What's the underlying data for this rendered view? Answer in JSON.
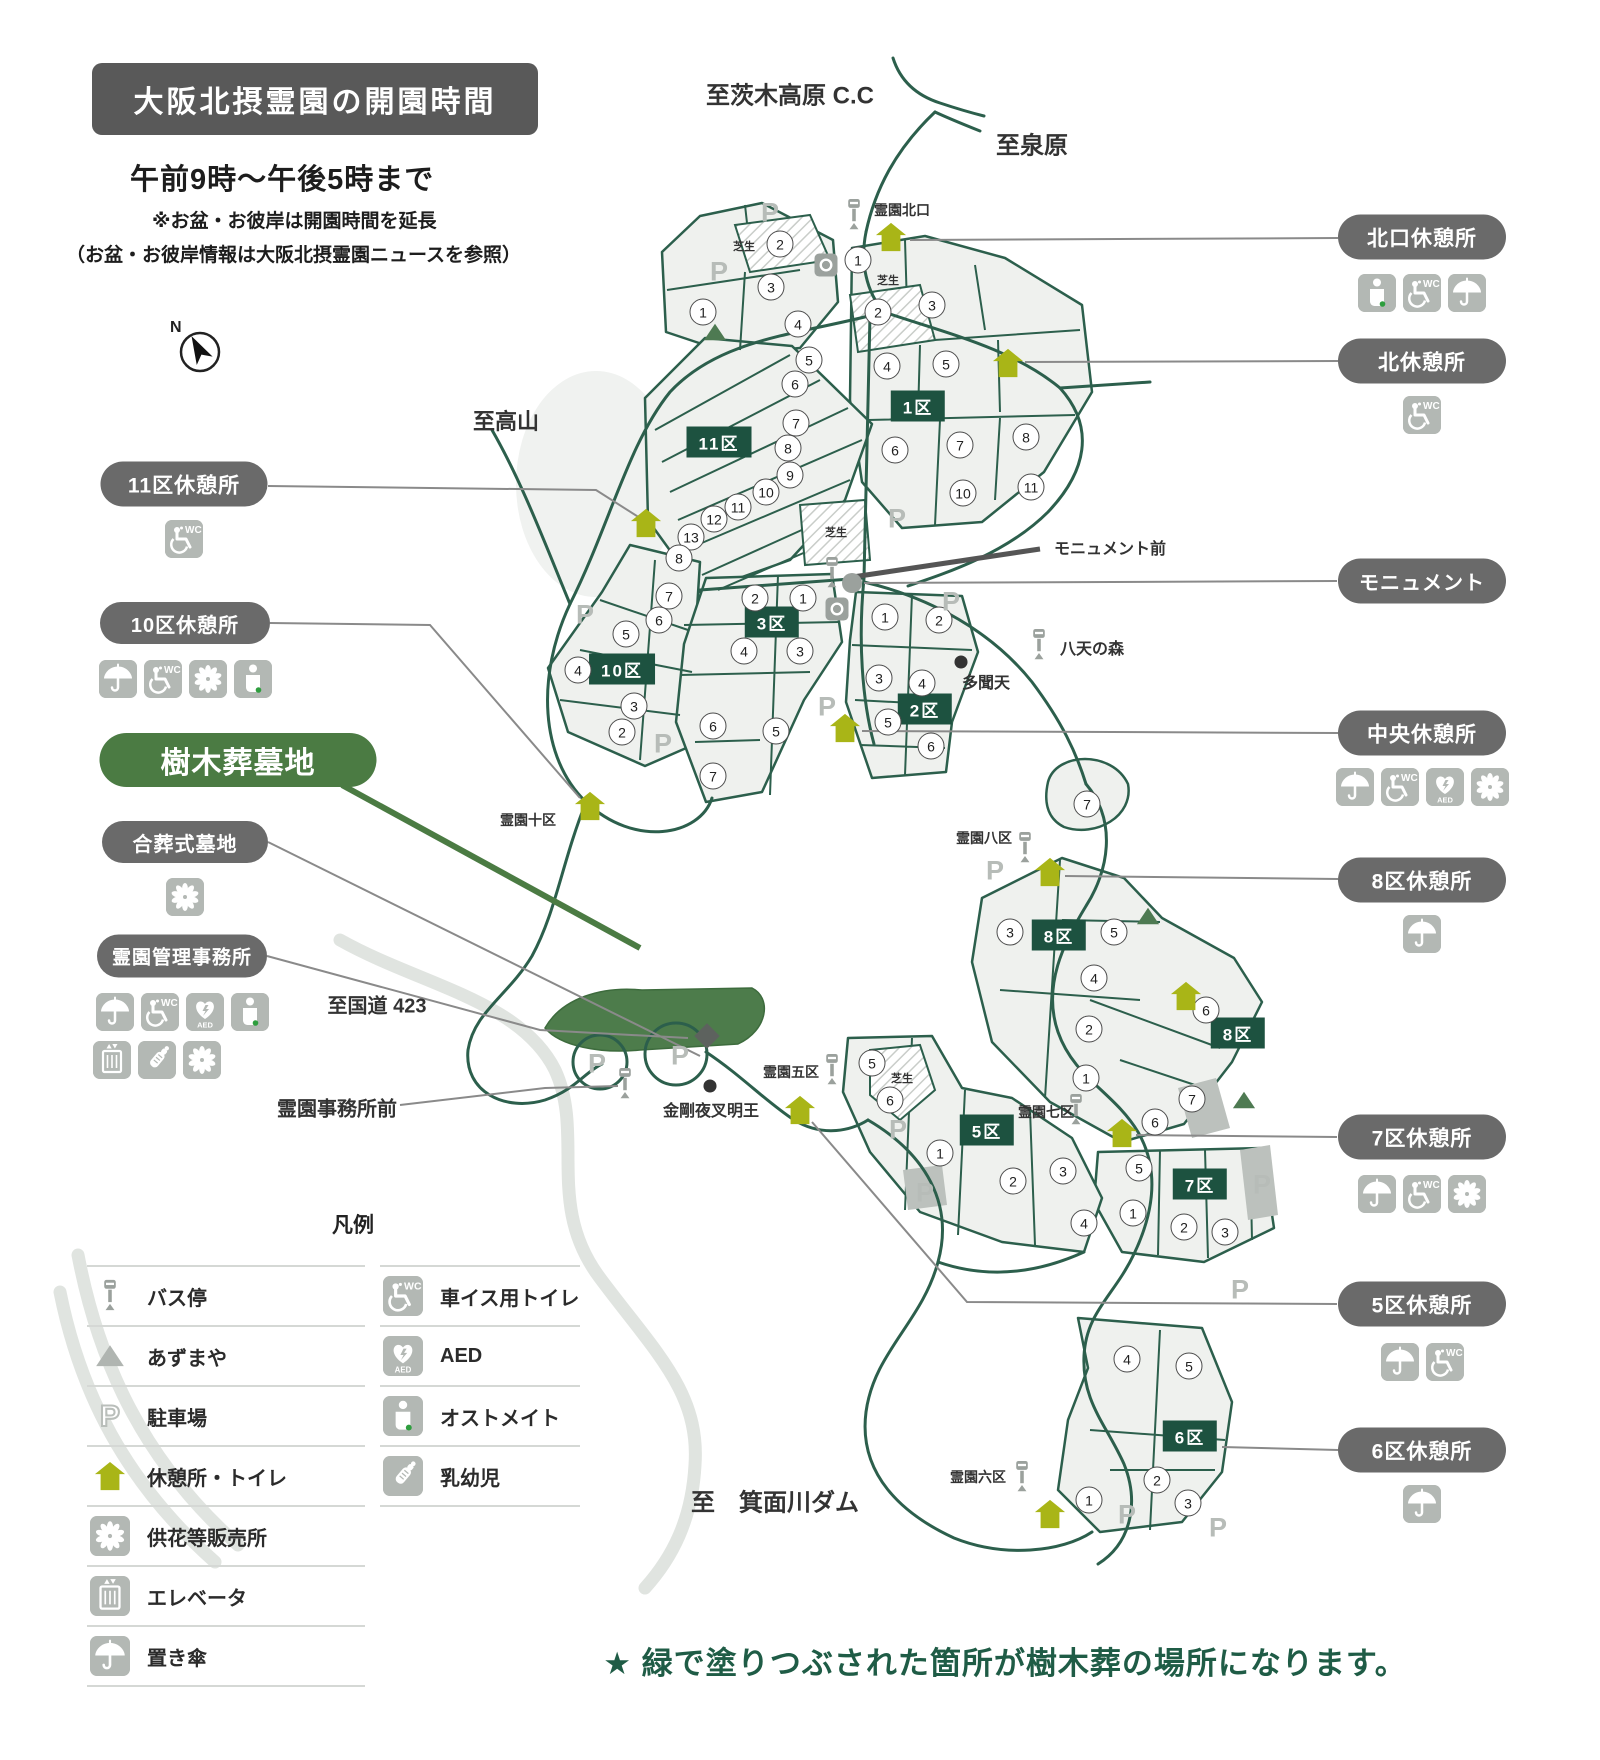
{
  "header": {
    "title": "大阪北摂霊園の開園時間",
    "hours": "午前9時〜午後5時まで",
    "note1": "※お盆・お彼岸は開園時間を延長",
    "note2": "（お盆・お彼岸情報は大阪北摂霊園ニュースを参照）"
  },
  "compass": {
    "label": "N"
  },
  "footer": {
    "note": "★ 緑で塗りつぶされた箇所が樹木葬の場所になります。"
  },
  "colors": {
    "road_green": "#2c5f4c",
    "plot_fill": "#eff1ee",
    "badge_green": "#1d5240",
    "resthouse_olive": "#a9b517",
    "pill_gray": "#6a6a6a",
    "pill_green": "#4b7b43",
    "tree_burial_green": "#4d7c4b",
    "footer_green": "#1f5c46",
    "icon_gray": "#b3b8b4"
  },
  "legend": {
    "title": "凡例",
    "left": [
      {
        "icon": "bus",
        "label": "バス停"
      },
      {
        "icon": "pavilion-gray",
        "label": "あずまや"
      },
      {
        "icon": "parking-outline",
        "label": "駐車場"
      },
      {
        "icon": "resthouse",
        "label": "休憩所・トイレ"
      },
      {
        "icon": "flower",
        "label": "供花等販売所"
      },
      {
        "icon": "elevator",
        "label": "エレベータ"
      },
      {
        "icon": "umbrella",
        "label": "置き傘"
      }
    ],
    "right": [
      {
        "icon": "wheelchair-wc",
        "label": "車イス用トイレ"
      },
      {
        "icon": "aed",
        "label": "AED"
      },
      {
        "icon": "ostomate",
        "label": "オストメイト"
      },
      {
        "icon": "baby",
        "label": "乳幼児"
      }
    ]
  },
  "callouts": [
    {
      "id": "kitaguchi-rest",
      "label": "北口休憩所",
      "x": 1422,
      "y": 237,
      "w": 168,
      "h": 45,
      "fs": 21,
      "style": "gray",
      "icons": [
        "ostomate",
        "wheelchair-wc",
        "umbrella"
      ],
      "icons_y": 274
    },
    {
      "id": "kita-rest",
      "label": "北休憩所",
      "x": 1422,
      "y": 361,
      "w": 168,
      "h": 45,
      "fs": 21,
      "style": "gray",
      "icons": [
        "wheelchair-wc"
      ],
      "icons_y": 396
    },
    {
      "id": "monument",
      "label": "モニュメント",
      "x": 1422,
      "y": 581,
      "w": 168,
      "h": 45,
      "fs": 20,
      "style": "gray",
      "icons": [],
      "icons_y": 0
    },
    {
      "id": "chuo-rest",
      "label": "中央休憩所",
      "x": 1422,
      "y": 733,
      "w": 168,
      "h": 45,
      "fs": 21,
      "style": "gray",
      "icons": [
        "umbrella",
        "wheelchair-wc",
        "aed",
        "flower"
      ],
      "icons_y": 768
    },
    {
      "id": "8ku-rest",
      "label": "8区休憩所",
      "x": 1422,
      "y": 880,
      "w": 168,
      "h": 45,
      "fs": 21,
      "style": "gray",
      "icons": [
        "umbrella"
      ],
      "icons_y": 915
    },
    {
      "id": "7ku-rest",
      "label": "7区休憩所",
      "x": 1422,
      "y": 1137,
      "w": 168,
      "h": 45,
      "fs": 21,
      "style": "gray",
      "icons": [
        "umbrella",
        "wheelchair-wc",
        "flower"
      ],
      "icons_y": 1175
    },
    {
      "id": "5ku-rest",
      "label": "5区休憩所",
      "x": 1422,
      "y": 1304,
      "w": 168,
      "h": 45,
      "fs": 21,
      "style": "gray",
      "icons": [
        "umbrella",
        "wheelchair-wc"
      ],
      "icons_y": 1343
    },
    {
      "id": "6ku-rest",
      "label": "6区休憩所",
      "x": 1422,
      "y": 1450,
      "w": 168,
      "h": 45,
      "fs": 21,
      "style": "gray",
      "icons": [
        "umbrella"
      ],
      "icons_y": 1485
    },
    {
      "id": "11ku-rest",
      "label": "11区休憩所",
      "x": 184,
      "y": 484,
      "w": 167,
      "h": 45,
      "fs": 21,
      "style": "gray",
      "icons": [
        "wheelchair-wc"
      ],
      "icons_y": 520
    },
    {
      "id": "10ku-rest",
      "label": "10区休憩所",
      "x": 185,
      "y": 623,
      "w": 170,
      "h": 42,
      "fs": 20,
      "style": "gray",
      "icons": [
        "umbrella",
        "wheelchair-wc",
        "flower",
        "ostomate"
      ],
      "icons_y": 660
    },
    {
      "id": "jumokuso",
      "label": "樹木葬墓地",
      "x": 238,
      "y": 760,
      "w": 277,
      "h": 54,
      "fs": 30,
      "style": "green",
      "icons": [],
      "icons_y": 0
    },
    {
      "id": "gassoshiki",
      "label": "合葬式墓地",
      "x": 185,
      "y": 842,
      "w": 166,
      "h": 42,
      "fs": 20,
      "style": "gray",
      "icons": [
        "flower"
      ],
      "icons_y": 878
    },
    {
      "id": "kanri-jimusho",
      "label": "霊園管理事務所",
      "x": 182,
      "y": 956,
      "w": 170,
      "h": 43,
      "fs": 19,
      "style": "gray",
      "icons": [
        "umbrella",
        "wheelchair-wc",
        "aed",
        "ostomate"
      ],
      "icons_y": 993,
      "icons2": [
        "elevator",
        "baby",
        "flower"
      ],
      "icons2_y": 1041,
      "icons2_align_x": 93
    }
  ],
  "map": {
    "labels": [
      {
        "text": "至茨木高原 C.C",
        "x": 790,
        "y": 93,
        "size": 24
      },
      {
        "text": "至泉原",
        "x": 1032,
        "y": 143,
        "size": 24
      },
      {
        "text": "至高山",
        "x": 506,
        "y": 420,
        "size": 22
      },
      {
        "text": "至国道 423",
        "x": 377,
        "y": 1004,
        "size": 20
      },
      {
        "text": "至　箕面川ダム",
        "x": 775,
        "y": 1500,
        "size": 24
      },
      {
        "text": "霊園北口",
        "x": 902,
        "y": 210,
        "size": 14
      },
      {
        "text": "モニュメント前",
        "x": 1110,
        "y": 547,
        "size": 16
      },
      {
        "text": "八天の森",
        "x": 1092,
        "y": 647,
        "size": 16
      },
      {
        "text": "多聞天",
        "x": 986,
        "y": 681,
        "size": 16
      },
      {
        "text": "霊園十区",
        "x": 528,
        "y": 820,
        "size": 14
      },
      {
        "text": "霊園八区",
        "x": 984,
        "y": 838,
        "size": 14
      },
      {
        "text": "霊園五区",
        "x": 791,
        "y": 1072,
        "size": 14
      },
      {
        "text": "霊園七区",
        "x": 1046,
        "y": 1112,
        "size": 14
      },
      {
        "text": "霊園六区",
        "x": 978,
        "y": 1477,
        "size": 14
      },
      {
        "text": "金剛夜叉明王",
        "x": 711,
        "y": 1109,
        "size": 16
      },
      {
        "text": "霊園事務所前",
        "x": 337,
        "y": 1107,
        "size": 20
      },
      {
        "text": "芝生",
        "x": 744,
        "y": 246,
        "size": 11
      },
      {
        "text": "芝生",
        "x": 888,
        "y": 280,
        "size": 11
      },
      {
        "text": "芝生",
        "x": 836,
        "y": 532,
        "size": 11
      },
      {
        "text": "芝生",
        "x": 902,
        "y": 1078,
        "size": 11
      }
    ],
    "zone_badges": [
      {
        "text": "11区",
        "x": 719,
        "y": 442
      },
      {
        "text": "1区",
        "x": 918,
        "y": 406
      },
      {
        "text": "3区",
        "x": 772,
        "y": 622
      },
      {
        "text": "10区",
        "x": 622,
        "y": 669
      },
      {
        "text": "2区",
        "x": 925,
        "y": 709
      },
      {
        "text": "8区",
        "x": 1059,
        "y": 935
      },
      {
        "text": "8区",
        "x": 1238,
        "y": 1033
      },
      {
        "text": "5区",
        "x": 987,
        "y": 1130
      },
      {
        "text": "7区",
        "x": 1200,
        "y": 1184
      },
      {
        "text": "6区",
        "x": 1190,
        "y": 1436
      }
    ],
    "plot_numbers": [
      {
        "n": "1",
        "x": 703,
        "y": 312
      },
      {
        "n": "2",
        "x": 780,
        "y": 244
      },
      {
        "n": "3",
        "x": 771,
        "y": 287
      },
      {
        "n": "4",
        "x": 798,
        "y": 324
      },
      {
        "n": "5",
        "x": 809,
        "y": 360
      },
      {
        "n": "6",
        "x": 795,
        "y": 384
      },
      {
        "n": "7",
        "x": 796,
        "y": 423
      },
      {
        "n": "8",
        "x": 788,
        "y": 448
      },
      {
        "n": "9",
        "x": 790,
        "y": 475
      },
      {
        "n": "10",
        "x": 766,
        "y": 492
      },
      {
        "n": "11",
        "x": 738,
        "y": 507
      },
      {
        "n": "12",
        "x": 714,
        "y": 519
      },
      {
        "n": "13",
        "x": 691,
        "y": 537
      },
      {
        "n": "8",
        "x": 679,
        "y": 558
      },
      {
        "n": "7",
        "x": 669,
        "y": 596
      },
      {
        "n": "6",
        "x": 659,
        "y": 620
      },
      {
        "n": "5",
        "x": 626,
        "y": 634
      },
      {
        "n": "4",
        "x": 578,
        "y": 670
      },
      {
        "n": "3",
        "x": 634,
        "y": 706
      },
      {
        "n": "2",
        "x": 622,
        "y": 732
      },
      {
        "n": "1",
        "x": 858,
        "y": 260
      },
      {
        "n": "2",
        "x": 878,
        "y": 312
      },
      {
        "n": "3",
        "x": 932,
        "y": 305
      },
      {
        "n": "4",
        "x": 887,
        "y": 366
      },
      {
        "n": "5",
        "x": 946,
        "y": 364
      },
      {
        "n": "6",
        "x": 895,
        "y": 450
      },
      {
        "n": "7",
        "x": 960,
        "y": 445
      },
      {
        "n": "8",
        "x": 1026,
        "y": 437
      },
      {
        "n": "10",
        "x": 963,
        "y": 493
      },
      {
        "n": "11",
        "x": 1031,
        "y": 487
      },
      {
        "n": "2",
        "x": 755,
        "y": 598
      },
      {
        "n": "1",
        "x": 803,
        "y": 598
      },
      {
        "n": "3",
        "x": 800,
        "y": 651
      },
      {
        "n": "4",
        "x": 744,
        "y": 651
      },
      {
        "n": "6",
        "x": 713,
        "y": 726
      },
      {
        "n": "5",
        "x": 776,
        "y": 731
      },
      {
        "n": "7",
        "x": 713,
        "y": 776
      },
      {
        "n": "1",
        "x": 885,
        "y": 617
      },
      {
        "n": "2",
        "x": 939,
        "y": 620
      },
      {
        "n": "3",
        "x": 879,
        "y": 678
      },
      {
        "n": "4",
        "x": 922,
        "y": 683
      },
      {
        "n": "5",
        "x": 888,
        "y": 722
      },
      {
        "n": "6",
        "x": 931,
        "y": 746
      },
      {
        "n": "7",
        "x": 1087,
        "y": 804
      },
      {
        "n": "3",
        "x": 1010,
        "y": 932
      },
      {
        "n": "5",
        "x": 1114,
        "y": 932
      },
      {
        "n": "4",
        "x": 1094,
        "y": 978
      },
      {
        "n": "2",
        "x": 1089,
        "y": 1029
      },
      {
        "n": "6",
        "x": 1206,
        "y": 1010
      },
      {
        "n": "1",
        "x": 1086,
        "y": 1078
      },
      {
        "n": "6",
        "x": 1155,
        "y": 1122
      },
      {
        "n": "7",
        "x": 1192,
        "y": 1099
      },
      {
        "n": "5",
        "x": 1139,
        "y": 1168
      },
      {
        "n": "1",
        "x": 1133,
        "y": 1213
      },
      {
        "n": "2",
        "x": 1184,
        "y": 1227
      },
      {
        "n": "3",
        "x": 1225,
        "y": 1232
      },
      {
        "n": "5",
        "x": 872,
        "y": 1063
      },
      {
        "n": "6",
        "x": 890,
        "y": 1100
      },
      {
        "n": "1",
        "x": 940,
        "y": 1153
      },
      {
        "n": "2",
        "x": 1013,
        "y": 1181
      },
      {
        "n": "3",
        "x": 1063,
        "y": 1171
      },
      {
        "n": "4",
        "x": 1084,
        "y": 1223
      },
      {
        "n": "4",
        "x": 1127,
        "y": 1359
      },
      {
        "n": "5",
        "x": 1189,
        "y": 1366
      },
      {
        "n": "1",
        "x": 1089,
        "y": 1500
      },
      {
        "n": "2",
        "x": 1157,
        "y": 1480
      },
      {
        "n": "3",
        "x": 1188,
        "y": 1503
      }
    ],
    "markers": [
      {
        "type": "bus",
        "x": 854,
        "y": 215
      },
      {
        "type": "bus",
        "x": 832,
        "y": 573
      },
      {
        "type": "bus",
        "x": 1039,
        "y": 645
      },
      {
        "type": "bus",
        "x": 1025,
        "y": 848
      },
      {
        "type": "bus",
        "x": 832,
        "y": 1070
      },
      {
        "type": "bus",
        "x": 1076,
        "y": 1110
      },
      {
        "type": "bus",
        "x": 1022,
        "y": 1477
      },
      {
        "type": "bus",
        "x": 625,
        "y": 1084
      },
      {
        "type": "parking",
        "x": 770,
        "y": 213
      },
      {
        "type": "parking",
        "x": 719,
        "y": 272
      },
      {
        "type": "parking",
        "x": 585,
        "y": 615
      },
      {
        "type": "parking",
        "x": 897,
        "y": 519
      },
      {
        "type": "parking",
        "x": 951,
        "y": 602
      },
      {
        "type": "parking",
        "x": 827,
        "y": 707
      },
      {
        "type": "parking",
        "x": 663,
        "y": 744
      },
      {
        "type": "parking",
        "x": 597,
        "y": 1064
      },
      {
        "type": "parking",
        "x": 680,
        "y": 1056
      },
      {
        "type": "parking",
        "x": 898,
        "y": 1130
      },
      {
        "type": "parking",
        "x": 995,
        "y": 871
      },
      {
        "type": "parking",
        "x": 925,
        "y": 1193
      },
      {
        "type": "parking",
        "x": 1262,
        "y": 1185
      },
      {
        "type": "parking",
        "x": 1240,
        "y": 1290
      },
      {
        "type": "parking",
        "x": 1127,
        "y": 1515
      },
      {
        "type": "parking",
        "x": 1218,
        "y": 1528
      },
      {
        "type": "resthouse",
        "x": 891,
        "y": 237
      },
      {
        "type": "resthouse",
        "x": 1008,
        "y": 363
      },
      {
        "type": "resthouse",
        "x": 646,
        "y": 523
      },
      {
        "type": "resthouse",
        "x": 590,
        "y": 806
      },
      {
        "type": "resthouse",
        "x": 845,
        "y": 728
      },
      {
        "type": "resthouse",
        "x": 1050,
        "y": 872
      },
      {
        "type": "resthouse",
        "x": 800,
        "y": 1110
      },
      {
        "type": "resthouse",
        "x": 1122,
        "y": 1133
      },
      {
        "type": "resthouse",
        "x": 1050,
        "y": 1514
      },
      {
        "type": "resthouse",
        "x": 1186,
        "y": 996
      },
      {
        "type": "pavilion",
        "x": 715,
        "y": 332
      },
      {
        "type": "pavilion",
        "x": 1148,
        "y": 916
      },
      {
        "type": "pavilion",
        "x": 1244,
        "y": 1100
      },
      {
        "type": "monument",
        "x": 852,
        "y": 583
      },
      {
        "type": "facility",
        "x": 826,
        "y": 265
      },
      {
        "type": "facility",
        "x": 837,
        "y": 609
      },
      {
        "type": "building",
        "x": 707,
        "y": 1036
      },
      {
        "type": "dot",
        "x": 961,
        "y": 662
      },
      {
        "type": "dot",
        "x": 710,
        "y": 1086
      }
    ]
  }
}
